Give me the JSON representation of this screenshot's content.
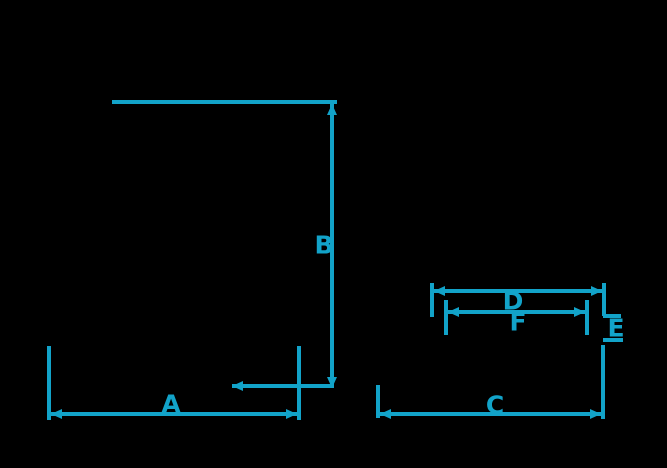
{
  "diagram": {
    "type": "dimension-diagram",
    "background_color": "#000000",
    "line_color": "#12a3c9",
    "dimension_labels": {
      "a": "A",
      "b": "B",
      "c": "C",
      "d": "D",
      "e": "E",
      "f": "F"
    }
  }
}
